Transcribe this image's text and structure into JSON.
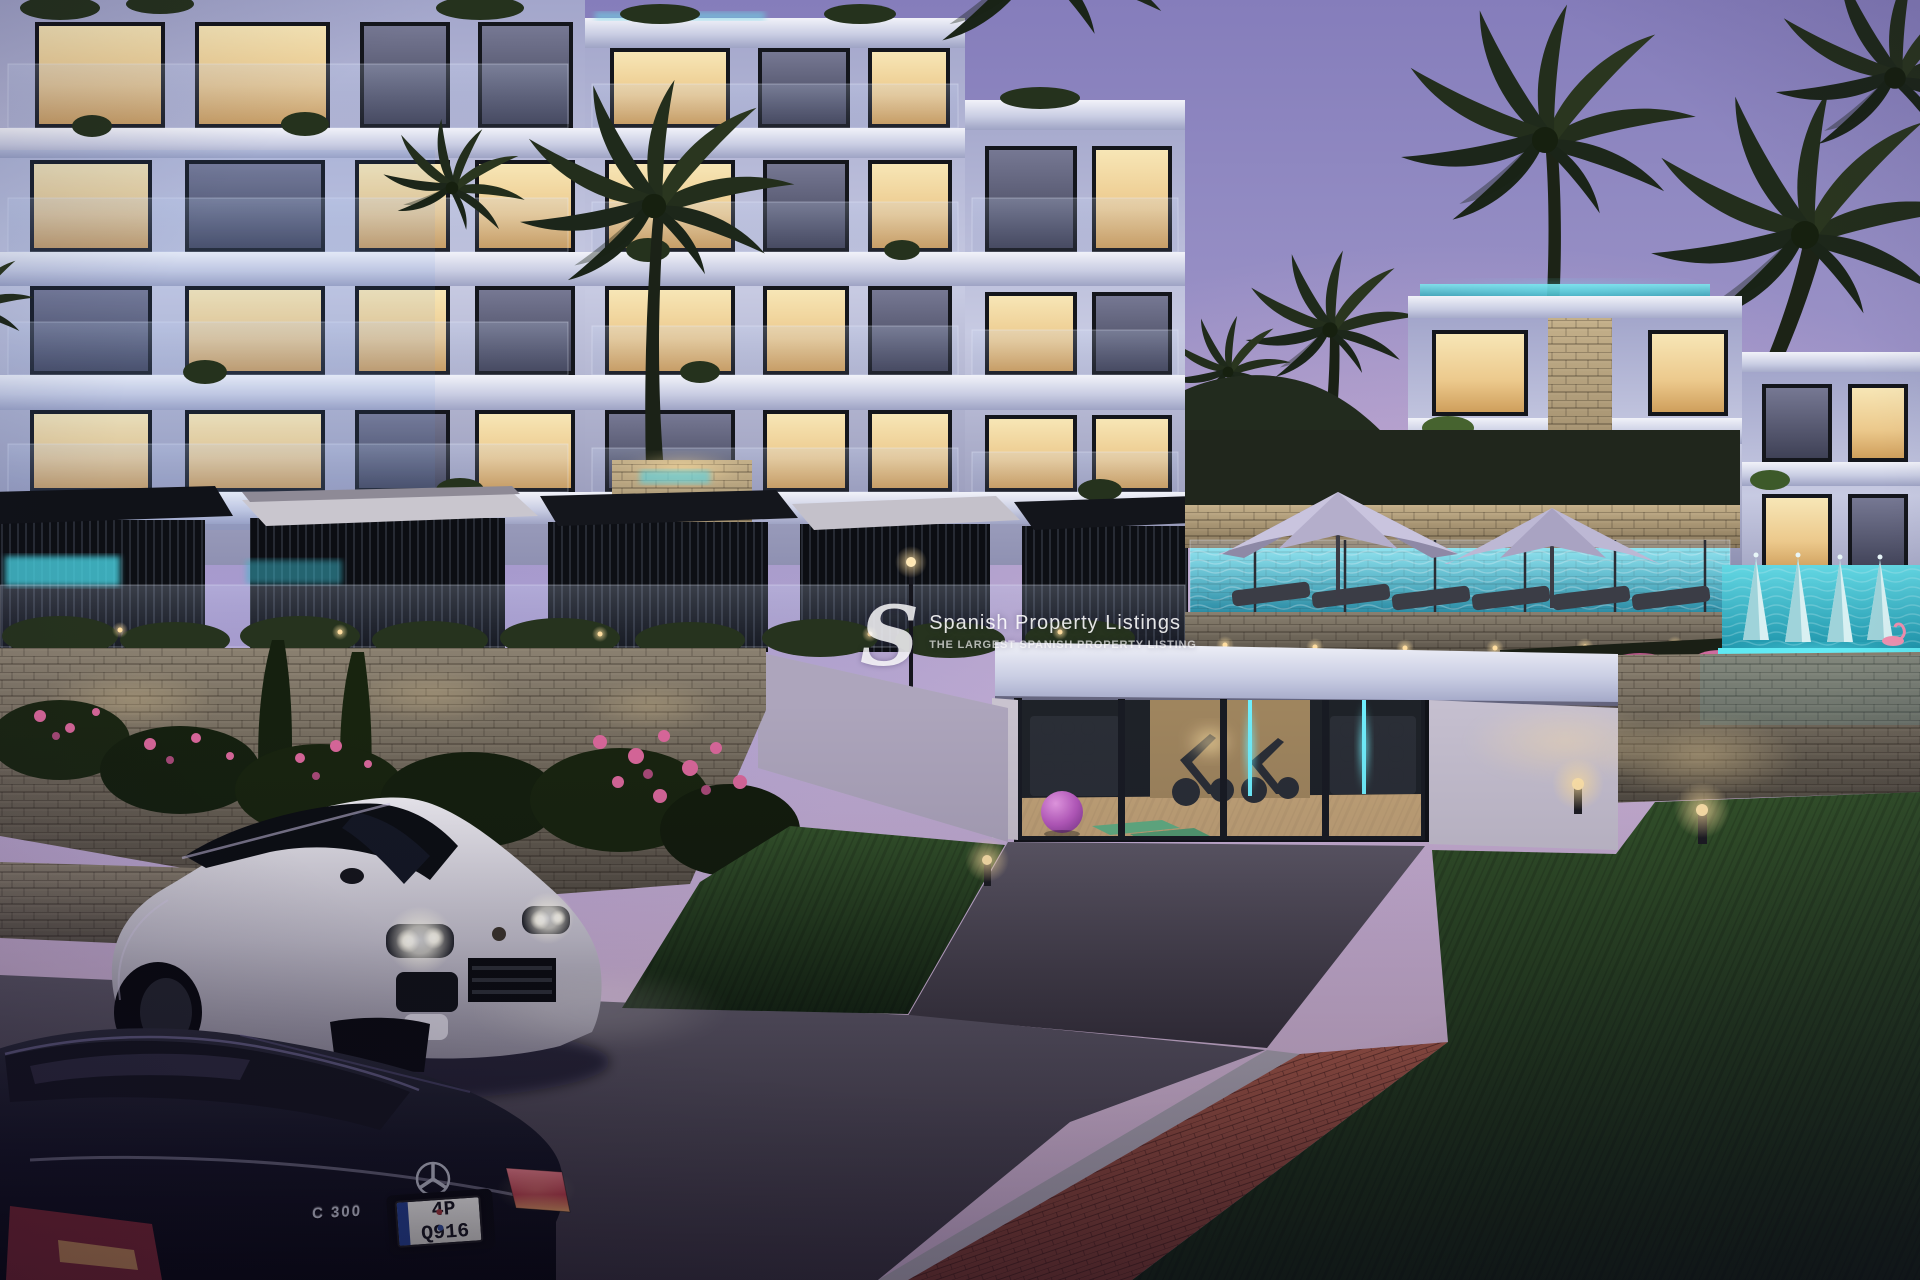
{
  "scene": {
    "description": "Twilight 3D architectural rendering of a modern terraced apartment complex with lit balconies, cabanas, pools, a glass-fronted gym, palm trees and two parked cars",
    "time_of_day": "dusk"
  },
  "watermark": {
    "logo_letter": "S",
    "line1": "Spanish Property Listings",
    "line2": "THE LARGEST SPANISH PROPERTY LISTING"
  },
  "vehicles": {
    "suv": {
      "color": "white",
      "style": "luxury SUV, headlights on"
    },
    "sedan": {
      "color": "black",
      "badge": "C 300",
      "plate": "4P Q916"
    }
  },
  "palette": {
    "sky_top": "#857dbb",
    "sky_horizon": "#d2b6d2",
    "facade": "#b6b8d6",
    "warm_window": "#f3dca4",
    "pool_teal": "#35c8d8",
    "led_cyan": "#5fe9f2",
    "stone_warm": "#b3a183",
    "stone_cool": "#6f685c",
    "grass": "#2c4a23",
    "brick": "#8f4a3c",
    "asphalt": "#4e4955",
    "ball_purple": "#c25fc4"
  }
}
